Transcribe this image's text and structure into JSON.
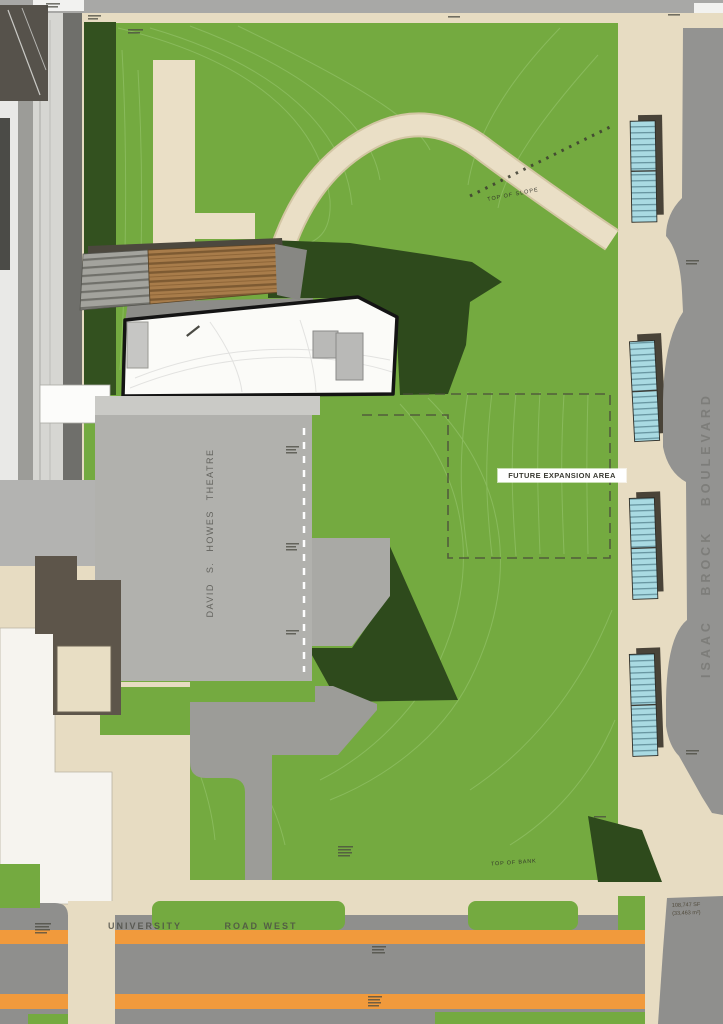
{
  "title": "Campus site plan — David S. Howes Theatre and future expansion area",
  "labels": {
    "future_expansion": "FUTURE EXPANSION AREA",
    "theatre": "DAVID S. HOWES THEATRE",
    "boulevard": "ISAAC BROCK BOULEVARD",
    "university": "UNIVERSITY",
    "road_west": "ROAD WEST",
    "top_of_slope": "TOP OF SLOPE",
    "top_of_bank": "TOP OF BANK",
    "area_line1": "108,747 SF",
    "area_line2": "(33,463 m²)"
  },
  "features": {
    "parking_bay_count": 4,
    "roads": [
      "UNIVERSITY ROAD WEST",
      "ISAAC BROCK BOULEVARD"
    ],
    "buildings": [
      "David S. Howes Theatre",
      "new building (white roof)",
      "wood-deck structure",
      "existing buildings (west edge)"
    ],
    "areas": [
      "lawn with contour lines",
      "future expansion area (dashed)",
      "curved walking path",
      "service plaza"
    ]
  },
  "colors": {
    "paving_tan": "#e7dcc2",
    "lawn_green": "#74aa40",
    "contour_green": "#8fbf63",
    "shadow_green": "#2e4a1c",
    "road_gray": "#8f8f8d",
    "median_orange": "#f19a3c",
    "parking_blue": "#a9dae2",
    "theatre_gray": "#b1b1ad",
    "roof_white": "#fbfbf8",
    "wood_brown": "#a87c4a"
  }
}
